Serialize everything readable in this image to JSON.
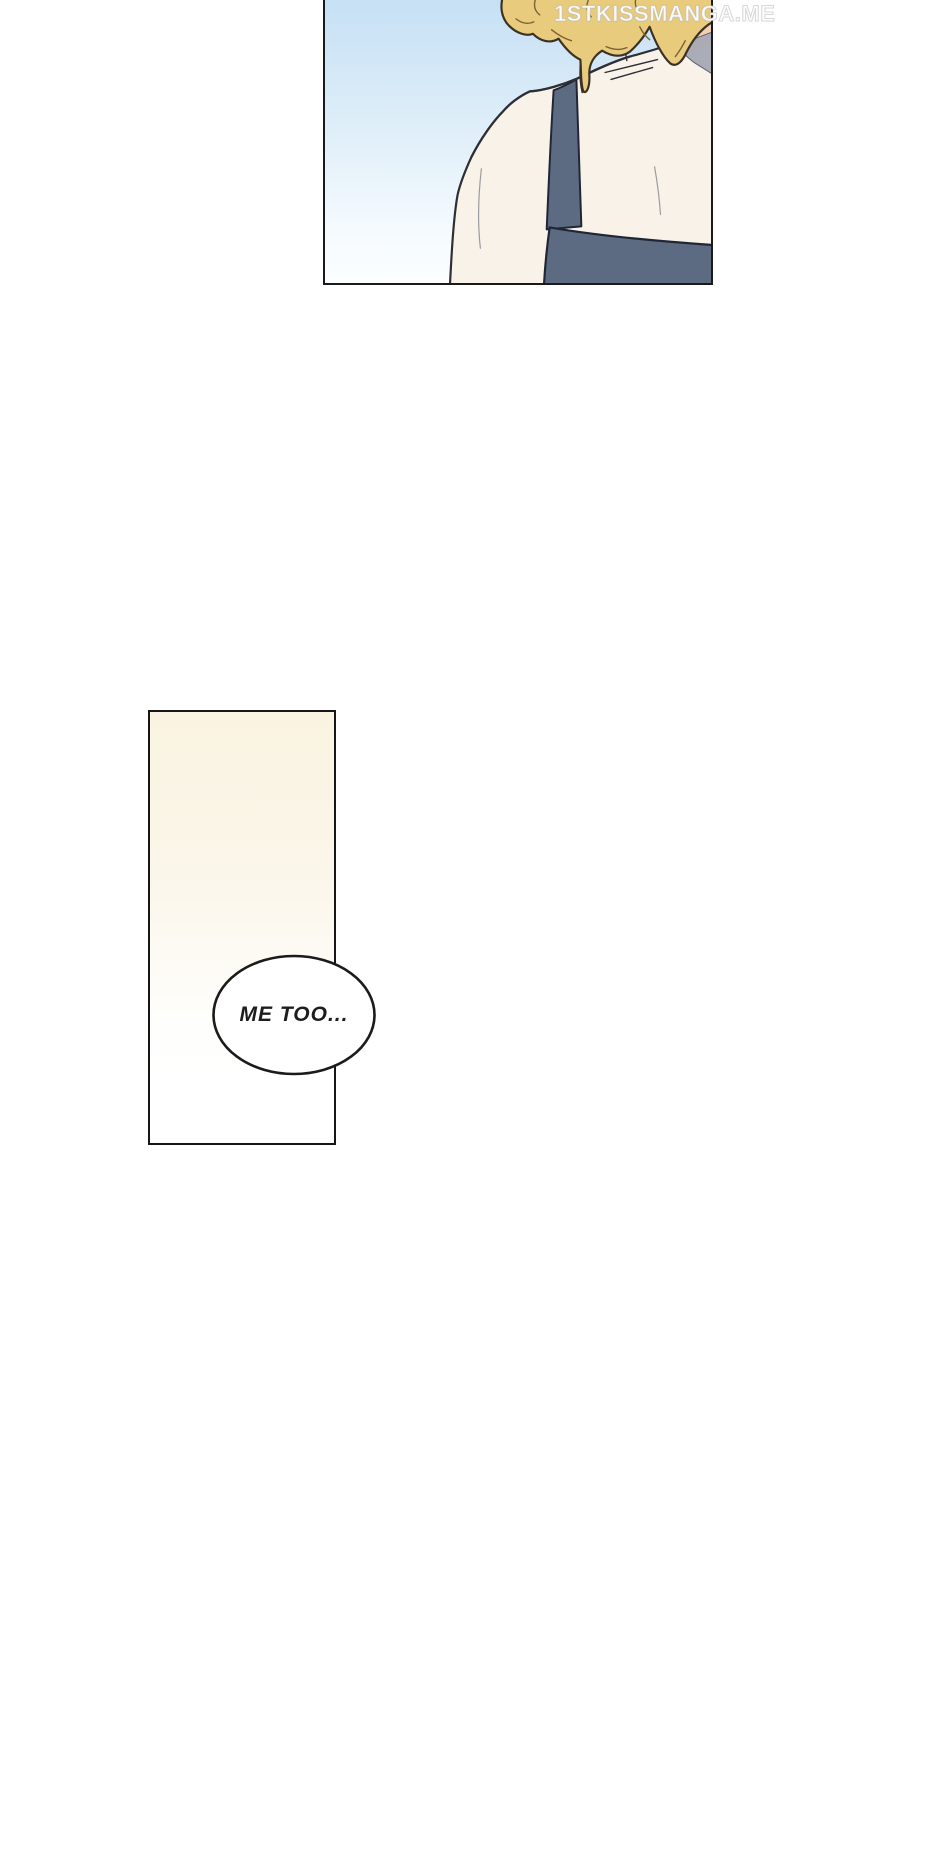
{
  "page": {
    "kind": "webtoon comic page",
    "background": "#FFFFFF",
    "width": 940,
    "height": 1862
  },
  "watermark": {
    "text": "1STKISSMANGA.ME",
    "color": "#FFFFFF"
  },
  "panels": [
    {
      "id": "sky-shoulder-panel",
      "description": "Back view of a person with curly blonde hair wearing a cream shirt and slate-blue overall straps against a blue sky gradient",
      "colors": {
        "sky_top": "#C6E0F4",
        "sky_bottom": "#FCFEFF",
        "hair": "#E9CB7E",
        "hair_outline": "#3A3126",
        "skin": "#F5CDAF",
        "skin_shadow": "#EDAF8C",
        "shirt": "#F8F2E9",
        "shirt_outline": "#2E2E36",
        "overalls": "#5C6B82",
        "overalls_outline": "#202636",
        "collar_shadow": "#A6AAB5",
        "border": "#1A1A1A"
      }
    },
    {
      "id": "cream-panel",
      "description": "Tall empty panel with warm cream glow fading to white",
      "colors": {
        "fill_top": "#FAF3E1",
        "fill_bottom": "#FFFFFF",
        "border": "#161616"
      },
      "bubble": {
        "text": "ME TOO...",
        "fill": "#FFFFFF",
        "stroke": "#1B1B1B",
        "text_color": "#1D1D1D"
      }
    }
  ]
}
